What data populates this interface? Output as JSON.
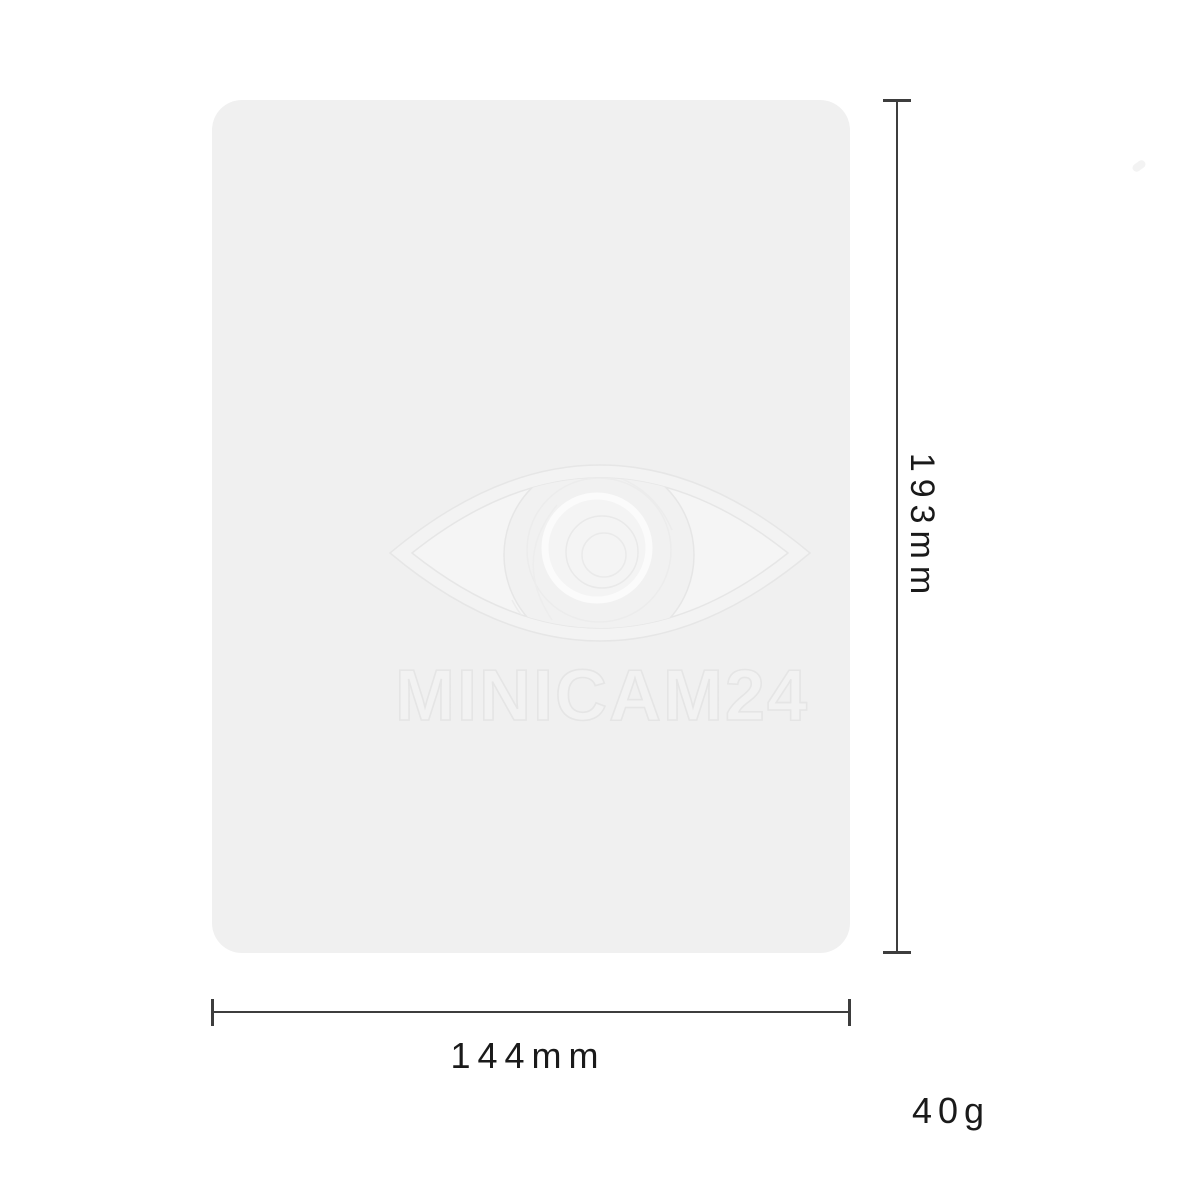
{
  "product": {
    "name": "product-panel",
    "watermark": {
      "icon": "eye-icon",
      "text": "MINICAM24"
    }
  },
  "dimensions": {
    "height_label": "193mm",
    "width_label": "144mm",
    "weight_label": "40g"
  },
  "colors": {
    "background": "#ffffff",
    "panel_fill": "#f0f0f0",
    "dimension_line": "#3d3d3d",
    "label_text": "#1a1a1a",
    "watermark_stroke_dark": "#e6e6e6",
    "watermark_stroke_light": "#fafafa",
    "watermark_fill": "#f3f3f3"
  }
}
